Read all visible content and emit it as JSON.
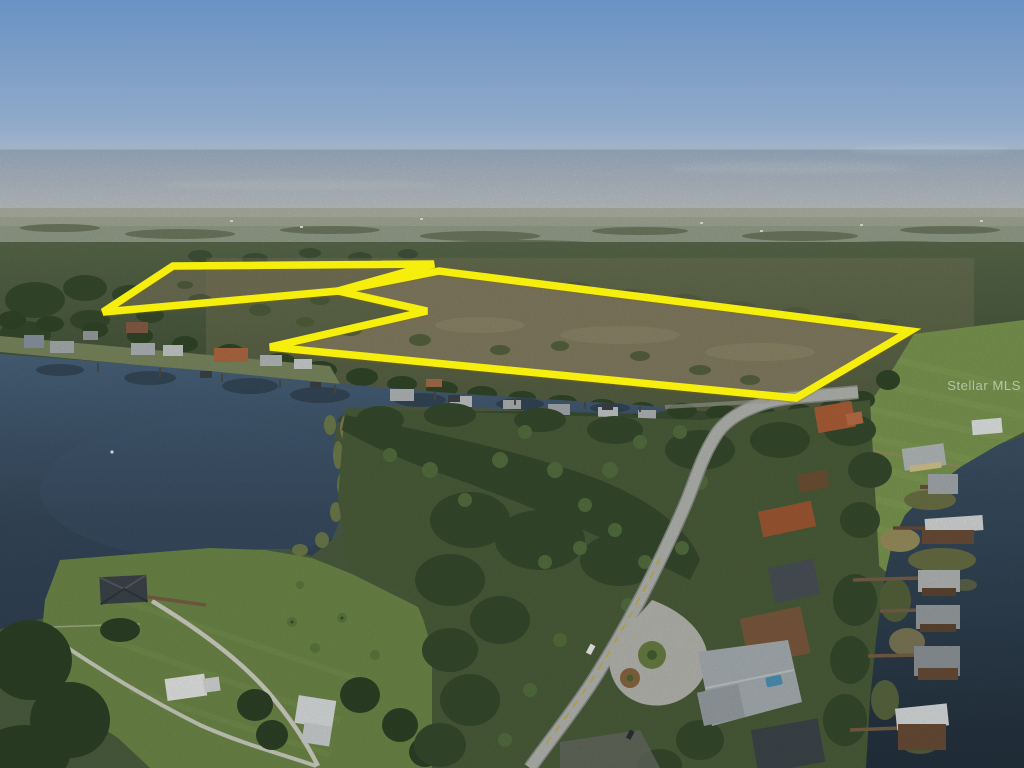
{
  "scene": {
    "type": "aerial-photograph",
    "subject": "Aerial drone photo of a large vacant land parcel outlined in yellow, bordered by a lake, a green field and a lakefront residential neighborhood"
  },
  "watermark": {
    "text": "Stellar MLS"
  },
  "colors": {
    "parcel_outline": "#f6ee11",
    "watermark": "#ffffff",
    "sky_top": "#6a92c4",
    "sky_horizon": "#c6cacc",
    "water_light": "#4a657e",
    "water_deep": "#2b3b4b",
    "field_green": "#7d9a52",
    "forest_dark": "#3c4f33",
    "marsh_brown": "#837e63",
    "road_gray": "#b7b9b3"
  },
  "parcel": {
    "stroke_width": "7.5",
    "upper_polygon_points": "103,312 173,266 434,264 338,291",
    "main_polygon_points": "338,291 439,271 910,331 796,398 270,347 427,311"
  }
}
